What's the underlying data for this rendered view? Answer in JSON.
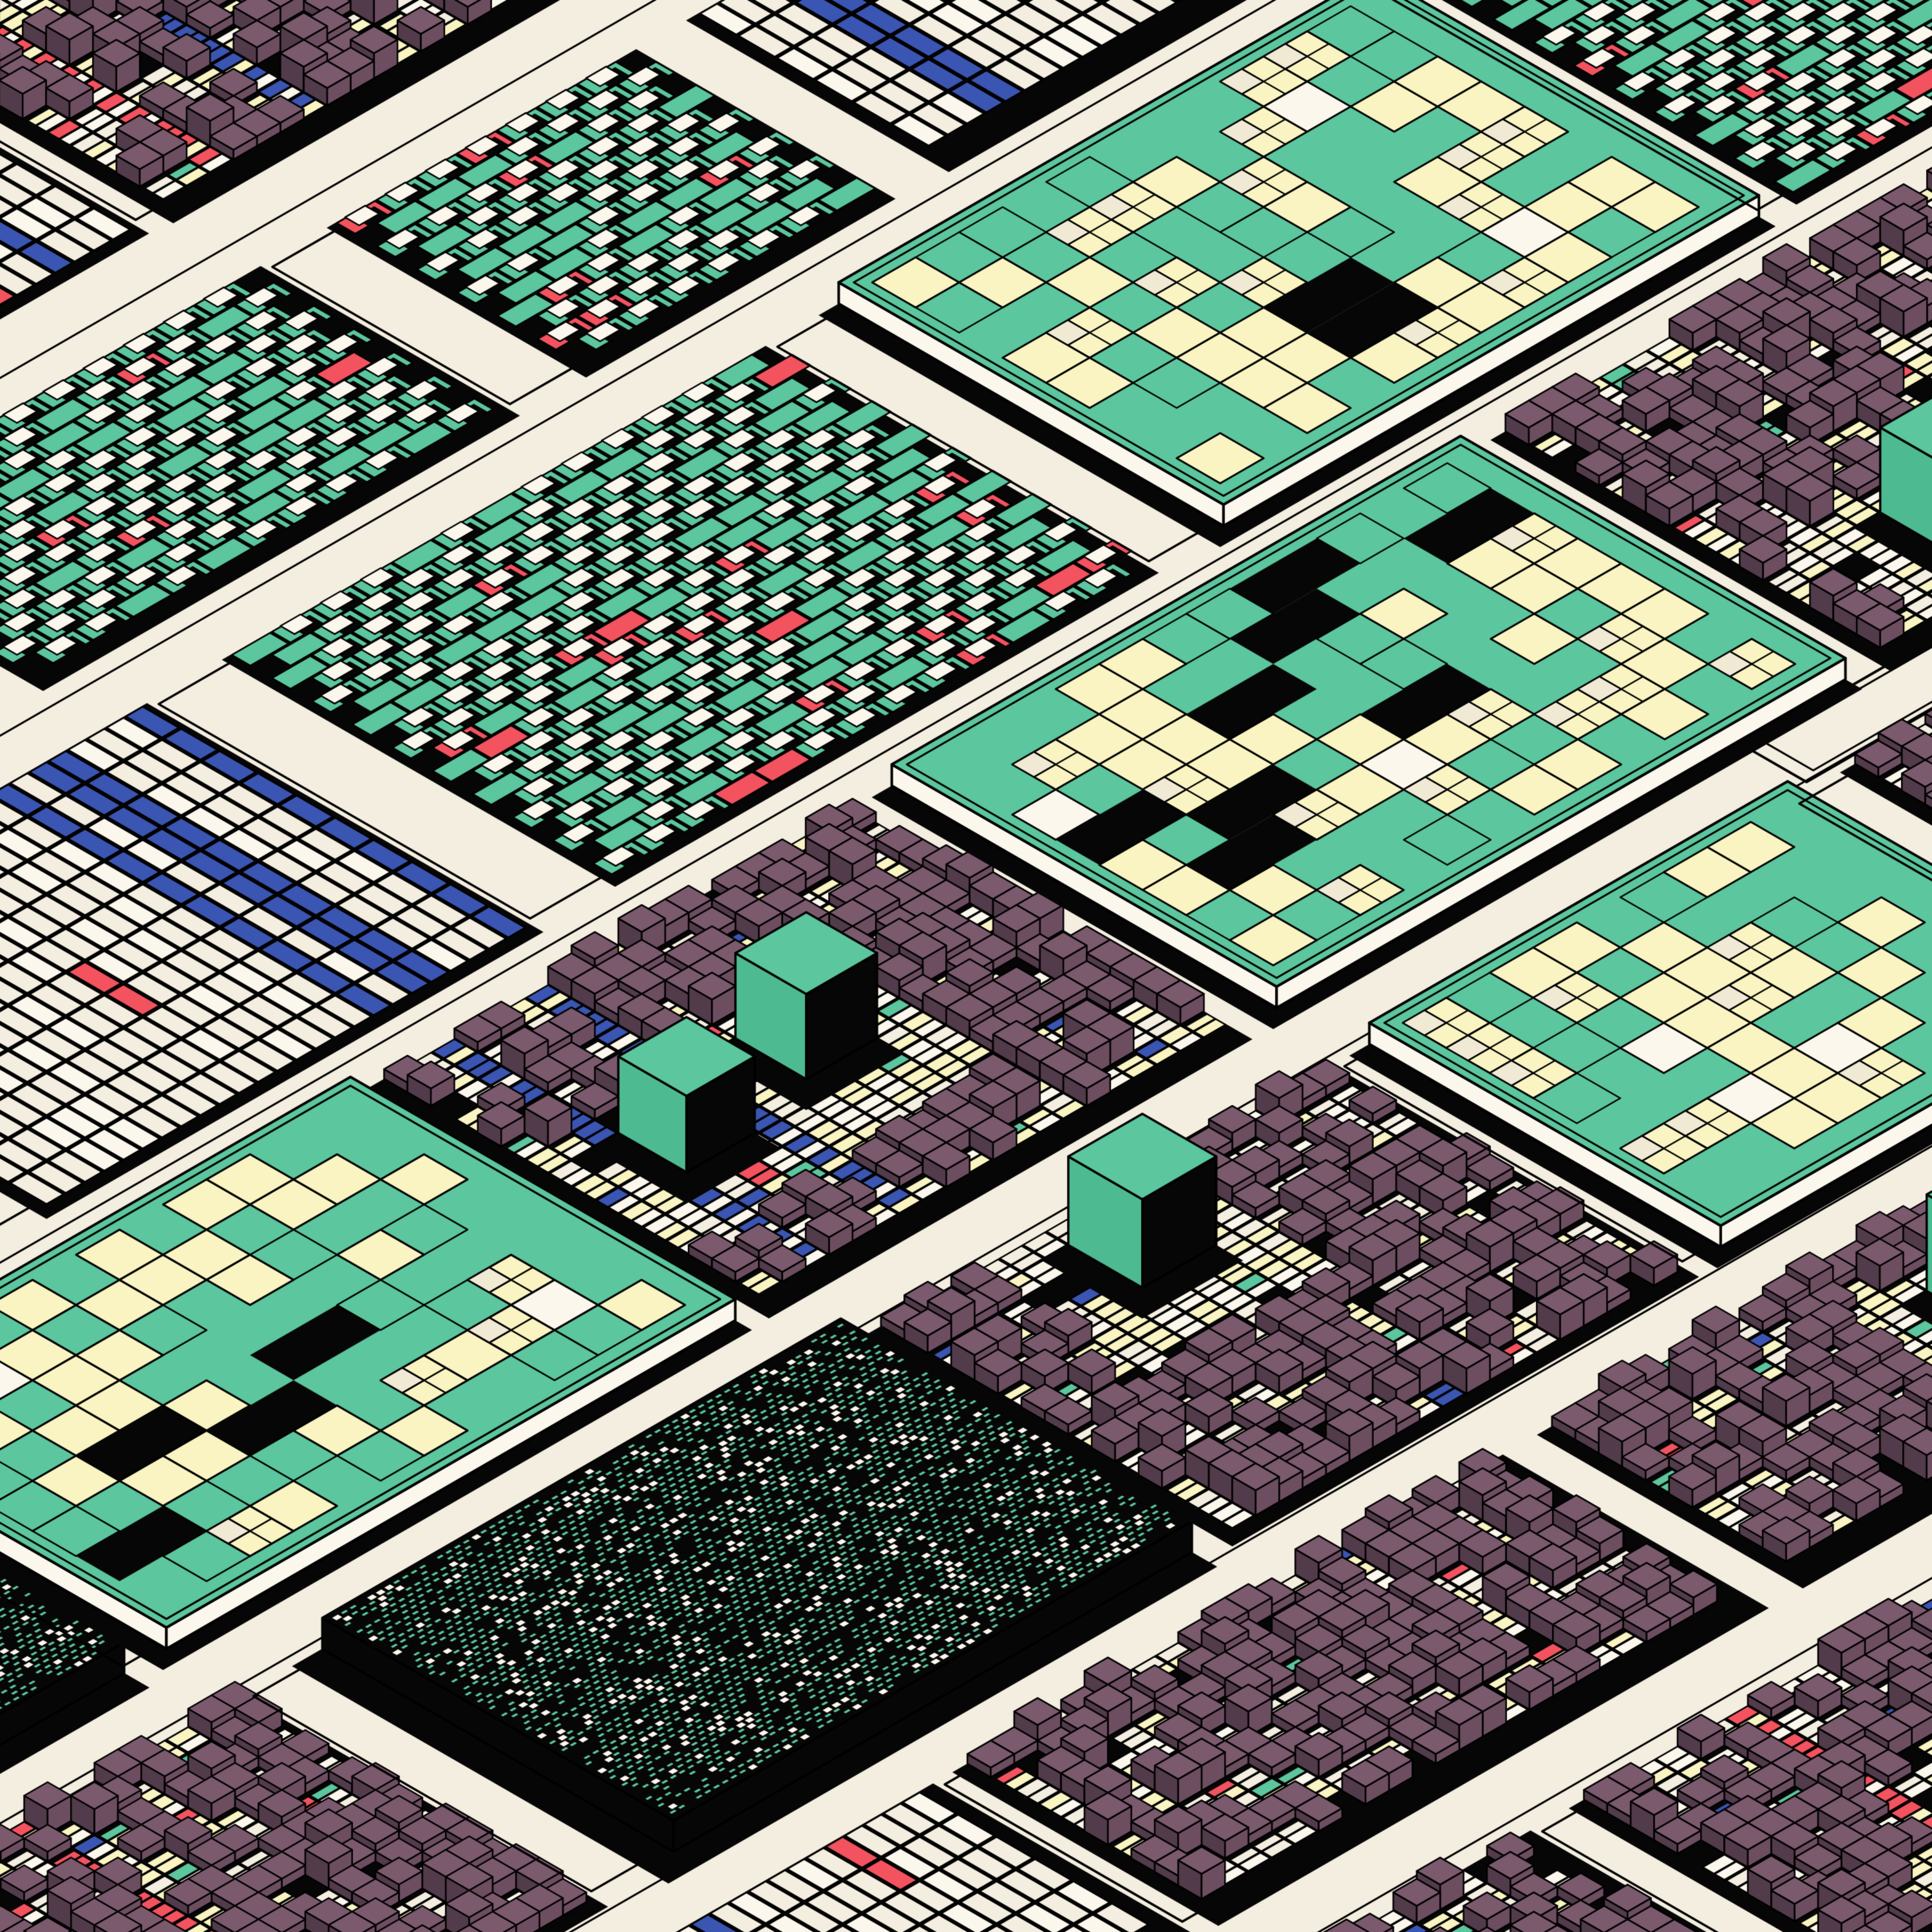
{
  "artwork": {
    "kind": "generative-isometric-city-pattern",
    "canvas_size": 3000,
    "seed": 20471,
    "background": "#f4eee0",
    "palette": {
      "cream": "#f4eee0",
      "cream_bright": "#fbf7ec",
      "pale_yellow": "#f9f4c1",
      "pane_cream": "#f0e9d4",
      "mauve_top": "#7b5a6e",
      "mauve_left": "#523b4a",
      "mauve_right": "#6d4e60",
      "teal": "#5cc69e",
      "teal_shade": "#4eba92",
      "blue": "#3a55b2",
      "red": "#f3525f",
      "black": "#060606",
      "outline": "#000000"
    },
    "geometry": {
      "unit": 30,
      "iso_cos": 0.866,
      "iso_sin": 0.5
    },
    "layout": {
      "band_width_min": 14,
      "band_width_max": 23,
      "street_width_min": 3,
      "street_width_max": 6,
      "block_length_min": 16,
      "block_length_max": 34,
      "block_gap_min": 2,
      "block_gap_max": 5,
      "block_type_weights": {
        "cubes": 0.52,
        "windows": 0.15,
        "hatch": 0.11,
        "mondrian": 0.1,
        "lots": 0.06,
        "steps": 0.06
      }
    },
    "cubes": {
      "pitch": 1.4,
      "density": 0.62,
      "heights": [
        0.5,
        0.9,
        1.3
      ],
      "height_weights": [
        0.4,
        0.4,
        0.2
      ],
      "ground_weights": {
        "cream": 0.34,
        "yellow": 0.26,
        "bright": 0.2,
        "skip": 0.08,
        "teal": 0.04,
        "red": 0.04,
        "blue": 0.04
      },
      "stripe_chance": 0.8,
      "big_cube_chance": 0.75,
      "second_big_cube_chance": 0.35,
      "big_cube_size": [
        3.0,
        4.6
      ],
      "big_cube_height": [
        3.8,
        5.6
      ]
    },
    "windows": {
      "plate_height": 1.1,
      "cell": 2.6,
      "fill_chances": {
        "teal": 0.5,
        "yellow": 0.28,
        "yellow_pane": 0.12,
        "cream": 0.05,
        "black_bar": 0.05
      }
    },
    "hatch": {
      "plate_height": 1.6,
      "du": 0.52,
      "dv": 0.36,
      "dash_chance": 0.6,
      "square_chance": 0.13
    },
    "mondrian": {
      "tile_u": 1.15,
      "tile_v": 2.3,
      "stripe_columns": [
        2,
        4
      ],
      "white_chance": 0.3
    },
    "steps": {
      "u_pitch": 2.4,
      "v_pitch": 1.2,
      "step_chance": 0.72,
      "red_chance": 0.09
    },
    "lots": {
      "accent_chance": 0.6
    }
  }
}
